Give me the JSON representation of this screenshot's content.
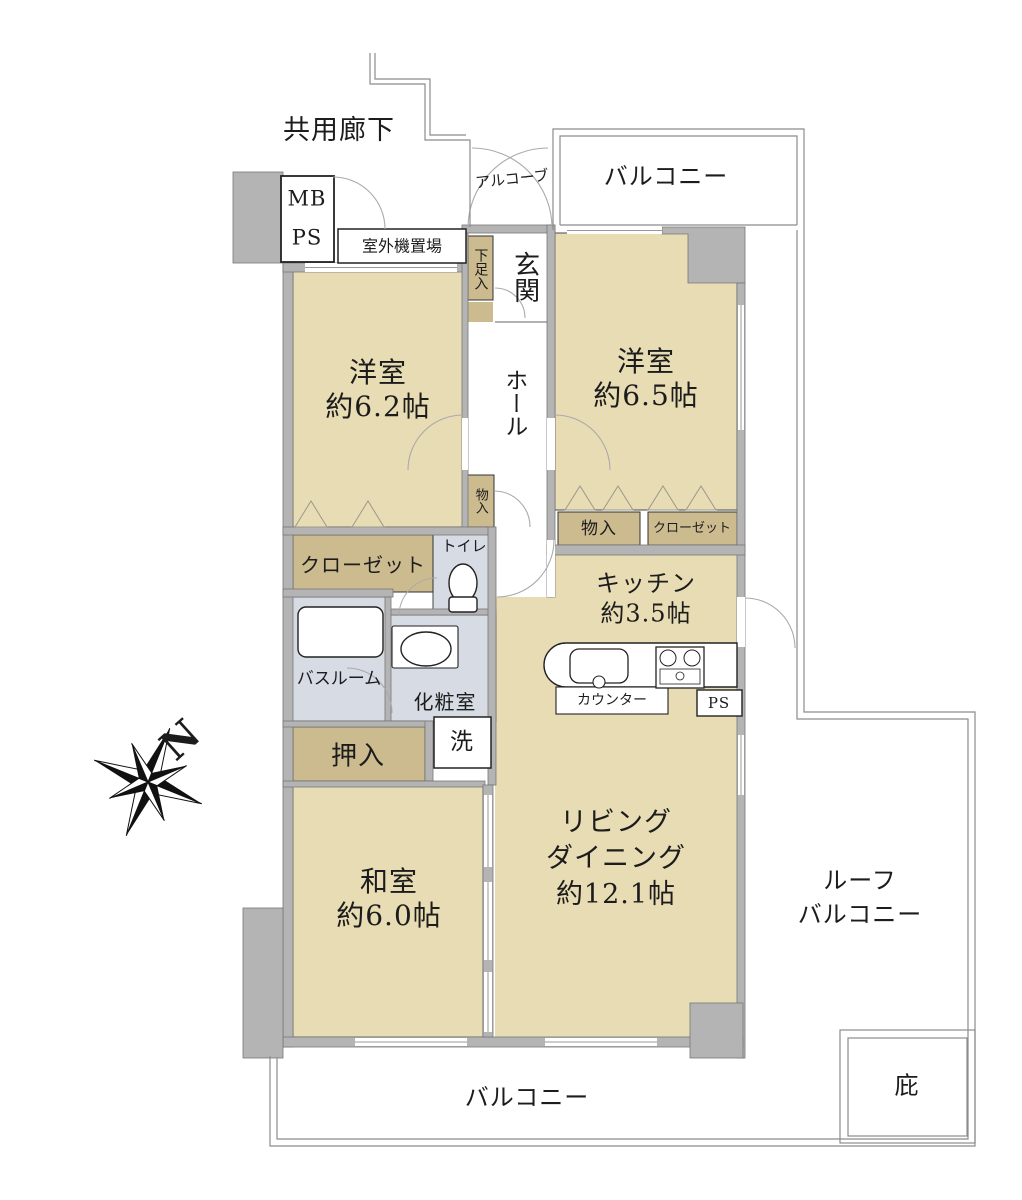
{
  "title": "マンション間取り図",
  "colors": {
    "room_tan": "#e8dcb4",
    "closet_tan": "#cdbb90",
    "wet_blue": "#d6dbe4",
    "wall_gray": "#b4b4b4",
    "line_gray": "#8c8c8c"
  },
  "labels": {
    "corridor": "共用廊下",
    "mb": "MB",
    "ps_meter": "PS",
    "outdoor_unit": "室外機置場",
    "alcove": "アルコーブ",
    "balcony_top": "バルコニー",
    "shoe_box": "下足入",
    "entrance": "玄関",
    "hall": "ホール",
    "western1_name": "洋室",
    "western1_size": "約6.2帖",
    "western2_name": "洋室",
    "western2_size": "約6.5帖",
    "storage_hall": "物入",
    "storage2": "物入",
    "closet2": "クローゼット",
    "closet1": "クローゼット",
    "toilet": "トイレ",
    "bathroom": "バスルーム",
    "powder_room": "化粧室",
    "laundry": "洗",
    "oshiire": "押入",
    "japanese_name": "和室",
    "japanese_size": "約6.0帖",
    "kitchen_name": "キッチン",
    "kitchen_size": "約3.5帖",
    "counter": "カウンター",
    "ps_shaft": "PS",
    "living1": "リビング",
    "living2": "ダイニング",
    "living3": "約12.1帖",
    "roof_balcony1": "ルーフ",
    "roof_balcony2": "バルコニー",
    "balcony_bottom": "バルコニー",
    "eaves": "庇",
    "compass_north": "N"
  }
}
